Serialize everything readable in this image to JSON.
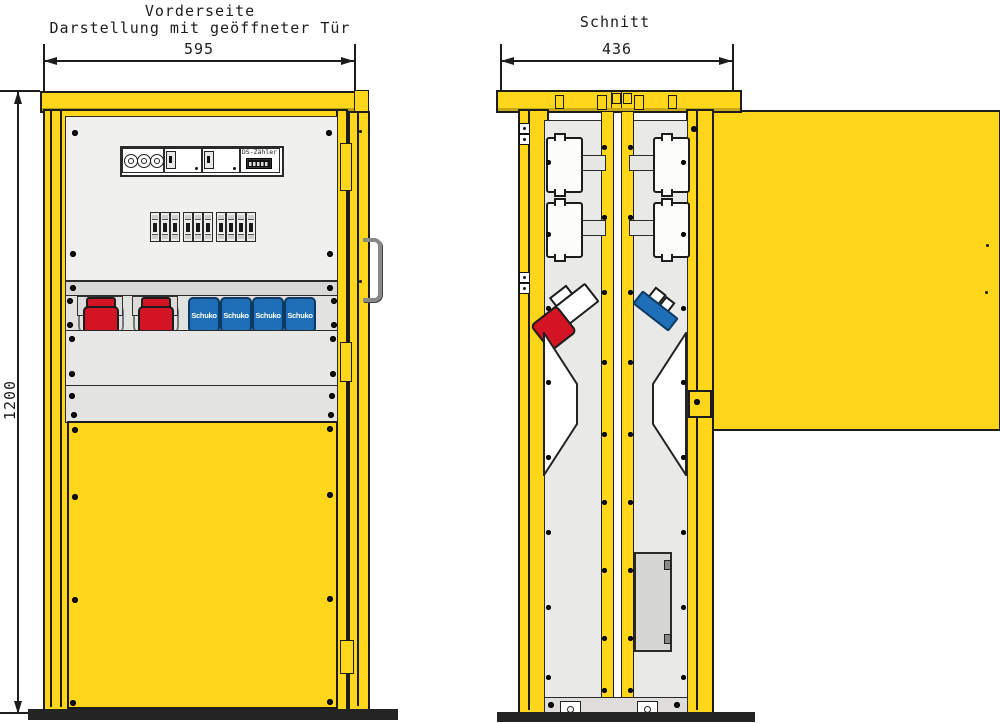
{
  "drawing": {
    "front": {
      "title_line1": "Vorderseite",
      "title_line2": "Darstellung mit geöffneter Tür",
      "width_dim": "595",
      "height_dim": "1200",
      "meter_label": "DS-Zähler",
      "schuko_labels": [
        "Schuko",
        "Schuko",
        "Schuko",
        "Schuko"
      ],
      "breaker_groups": [
        3,
        3,
        4
      ],
      "cee_socket_count": 2
    },
    "section": {
      "title": "Schnitt",
      "width_dim": "436"
    },
    "colors": {
      "cabinet_yellow": "#FFD61A",
      "outline": "#1C1C1C",
      "panel_light": "#F0F0EE",
      "panel_gray": "#E2E2E0",
      "cee_red": "#D21424",
      "schuko_blue": "#1E6FB8",
      "base_dark": "#242424"
    }
  }
}
